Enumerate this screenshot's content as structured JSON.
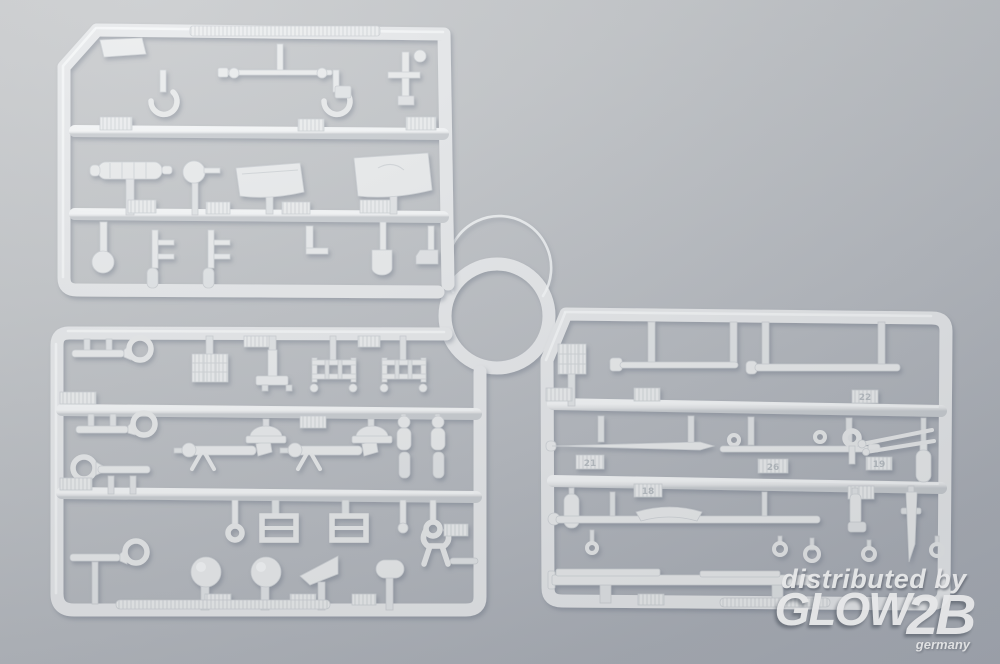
{
  "scene": {
    "description": "Product photo of three light-grey injection-moulded plastic model kit sprues with small accessory parts (tow cables, hooks, machine guns, ladders, headlights, tools, barrels), lying on a neutral grey background with a circular cutout between the frames.",
    "colors": {
      "background_top": "#cbcdcf",
      "background_bottom": "#a8adb6",
      "plastic": "#e8eaec",
      "plastic_highlight": "#f8fafb",
      "shadow": "#6b7484"
    }
  },
  "sprues": {
    "top_left": {
      "name": "sprue A (top left)",
      "part_tags": []
    },
    "bottom_left": {
      "name": "sprue B (bottom left)",
      "part_tags": []
    },
    "right": {
      "name": "sprue C (right)",
      "part_tags": [
        {
          "label": "21"
        },
        {
          "label": "26"
        },
        {
          "label": "19"
        },
        {
          "label": "18"
        },
        {
          "label": "22"
        }
      ]
    }
  },
  "watermark": {
    "line1": "distributed by",
    "brand": "GLOW",
    "brand_suffix": "2B",
    "country": "germany"
  }
}
